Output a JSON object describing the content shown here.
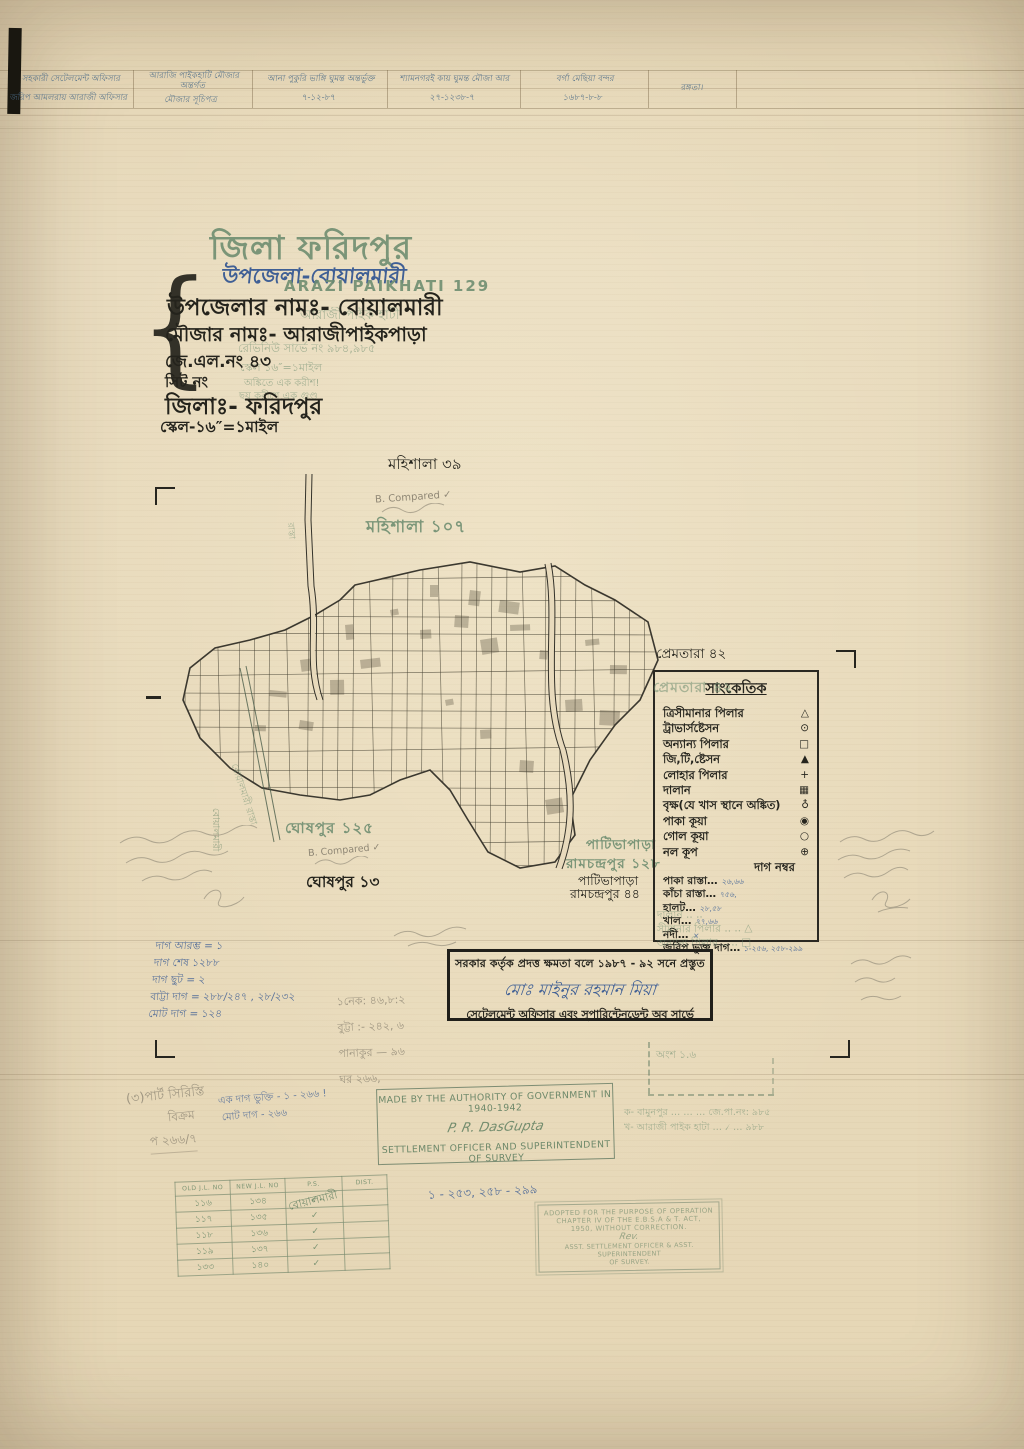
{
  "colors": {
    "paper": "#e8dabc",
    "ink": "#24231c",
    "stamp_green": "#6f8e71",
    "handwriting_blue": "#3f5f95",
    "pencil": "#8f8775"
  },
  "header_row": {
    "cells": [
      {
        "l1": "সহকারী সেটেলমেন্ট অফিসার",
        "l2": "জরিপ আমলরায় আরাজী অফিসার"
      },
      {
        "l1": "আরাজি পাইকহাটি মৌজার অন্তর্গত",
        "l2": "মৌজার সূচিপত্র"
      },
      {
        "l1": "আনা পুকুরি ভাঙ্গি ঘুমন্ত অন্তর্ভুক্ত",
        "l2": "৭-১২-৮৭"
      },
      {
        "l1": "শ্যামনগরই কায় ঘুমন্ত মৌজা আর",
        "l2": "২৭-১২৩৮-৭"
      },
      {
        "l1": "বর্গা মেছিয়া বন্দর",
        "l2": "১৬৮৭-৮-৮"
      },
      {
        "l1": "রঙ্গতা।",
        "l2": ""
      }
    ]
  },
  "title_block": {
    "district_stamp": "জিলা ফরিদপুর",
    "upazila_handwritten": "উপজেলা-বোয়ালমারী",
    "arazi_stamp": "ARAZI PAIKHATI 129",
    "line1": "উপজেলার নামঃ- বোয়ালমারী",
    "line2": "মৌজার নামঃ- আরাজীপাইকপাড়া",
    "line3": "জে.এল.নং ৪৩",
    "line4": "সিট নং",
    "line5": "জিলাঃ- ফরিদপুর",
    "line6": "স্কেল-১৬″=১মাইল",
    "ghost1": "আরাজী পাইক হাটী",
    "ghost2": "রেভিনিউ সার্ভে নং ৯৮৪,৯৮৫",
    "ghost3": "স্কেল ১৬″=১মাইল",
    "ghost4": "অঙ্কিতে এক করীশ!",
    "ghost5": "ছয় করীশে এক গুণ্ড"
  },
  "map_labels": {
    "mahishala39": "মহিশালা ৩৯",
    "mahishala107": "মহিশালা ১০৭",
    "prematara42": "প্রেমতারা ৪২",
    "ghoshpur125": "ঘোষপুর ১২৫",
    "ghoshpur13": "ঘোষপুর ১৩",
    "patipara_green1": "পাটিভাপাড়া",
    "patipara_green2": "রামচন্দ্রপুর ১২৮",
    "patipara_black1": "পাটিভাপাড়া",
    "patipara_black2": "রামচন্দ্রপুর ৪৪",
    "road_left": "বোয়ালমারী রাস্তা",
    "road_top": "রাস্তা",
    "boalmari_stamp": "বোয়ালমারী",
    "compared_note": "B. Compared ✓"
  },
  "legend": {
    "title": "সাংকেতিক",
    "ghost_stamp": "প্রেমতারা ৪২",
    "items": [
      {
        "label": "ত্রিসীমানার পিলার",
        "symbol": "△"
      },
      {
        "label": "ট্রাভার্সষ্টেসন",
        "symbol": "⊙"
      },
      {
        "label": "অন্যান্য পিলার",
        "symbol": "□"
      },
      {
        "label": "জি,টি,ষ্টেসন",
        "symbol": "▲"
      },
      {
        "label": "লোহার পিলার",
        "symbol": "+"
      },
      {
        "label": "দালান",
        "symbol": "▦"
      },
      {
        "label": "বৃক্ষ(যে খাস স্থানে অঙ্কিত)",
        "symbol": "♁"
      },
      {
        "label": "পাকা কূয়া",
        "symbol": "◉"
      },
      {
        "label": "গোল কূয়া",
        "symbol": "○"
      },
      {
        "label": "নল কূপ",
        "symbol": "⊕"
      }
    ],
    "dag_heading": "দাগ নম্বর",
    "dag_items": [
      {
        "label": "পাকা রাস্তা…",
        "value": "২৬,৬৬"
      },
      {
        "label": "কাঁচা রাস্তা…",
        "value": "৭৫৬,"
      },
      {
        "label": "হালট…",
        "value": "২৮,৫৮"
      },
      {
        "label": "খাল…",
        "value": "৭৭,৬৬"
      },
      {
        "label": "নদী…",
        "value": "×"
      },
      {
        "label": "জরিপ ভুক্ত দাগ…",
        "value": "১-২৫৬, ২৫৮-২৯৯"
      }
    ],
    "ghost_lines": [
      "দালান ..  ..",
      "সীমানার পিলার ..  ..  △",
      "অন্যান্য পিলার ..  ..  □"
    ]
  },
  "stamps": {
    "authorization": {
      "line1": "সরকার কর্তৃক প্রদত্ত ক্ষমতা বলে ১৯৮৭ - ৯২ সনে প্রস্তুত",
      "signature": "মোঃ মাইনুর রহমান মিয়া",
      "line2": "সেটেলমেন্ট অফিসার এবং সুপারিন্টেনডেন্ট অব সার্ভে"
    },
    "made_by": {
      "line1": "MADE BY THE AUTHORITY OF GOVERNMENT IN 1940-1942",
      "signature": "P. R. DasGupta",
      "line2": "SETTLEMENT OFFICER AND SUPERINTENDENT OF SURVEY"
    },
    "adopted": {
      "l1": "ADOPTED FOR THE PURPOSE OF OPERATION",
      "l2": "CHAPTER IV OF THE E.B.S.A & T. ACT,",
      "l3": "1950, WITHOUT CORRECTION.",
      "sig": "Rev.",
      "l4": "ASST. SETTLEMENT OFFICER & ASST. SUPERINTENDENT",
      "l5": "OF SURVEY."
    }
  },
  "green_box": {
    "part_label": "অংশ ১.৬",
    "line_a": "ক- বামুনপুর …  …  …  জে.পা.নং: ৯৮৫",
    "line_b": "খ- আরাজী পাইক হাটা …  ৴  …  ৯৮৮"
  },
  "jl_table": {
    "headers": [
      "OLD J.L. NO",
      "NEW J.L. NO",
      "P.S.",
      "DIST."
    ],
    "ps_overlay": "বোয়ালমারী",
    "check": "✓",
    "rows": [
      [
        "১১৬",
        "১৩৪"
      ],
      [
        "১১৭",
        "১৩৫"
      ],
      [
        "১১৮",
        "১৩৬"
      ],
      [
        "১১৯",
        "১৩৭"
      ],
      [
        "১৩৩",
        "১৪০"
      ]
    ]
  },
  "annotations": {
    "blue_left": [
      "দাগ আরম্ভ = ১",
      "দাগ শেষ ১২৮৮",
      "দাগ ছুট = ২",
      "বাট্টা দাগ = ২৮৮/২৪৭ , ২৮/২৩২",
      "মোট দাগ = ১২৪"
    ],
    "pencil_mid": [
      "১নেক: ৪৬,৮:২",
      "বুট্টা :- ২৪২, ৬",
      "পানাকুর — ৯৬",
      "ঘর ২৬৬,"
    ],
    "blue_range": "১ - ২৫৩, ২৫৮ - ২৯৯",
    "pencil_part": [
      "(৩)পার্ট সিরিস্তি",
      "বিক্রম",
      "প ২৬৬/৭"
    ],
    "blue_bottom": [
      "এক দাগ ভুক্তি - ১ - ২৬৬ !",
      "মোট দাগ - ২৬৬"
    ],
    "compared": "B. Compared ✓"
  }
}
